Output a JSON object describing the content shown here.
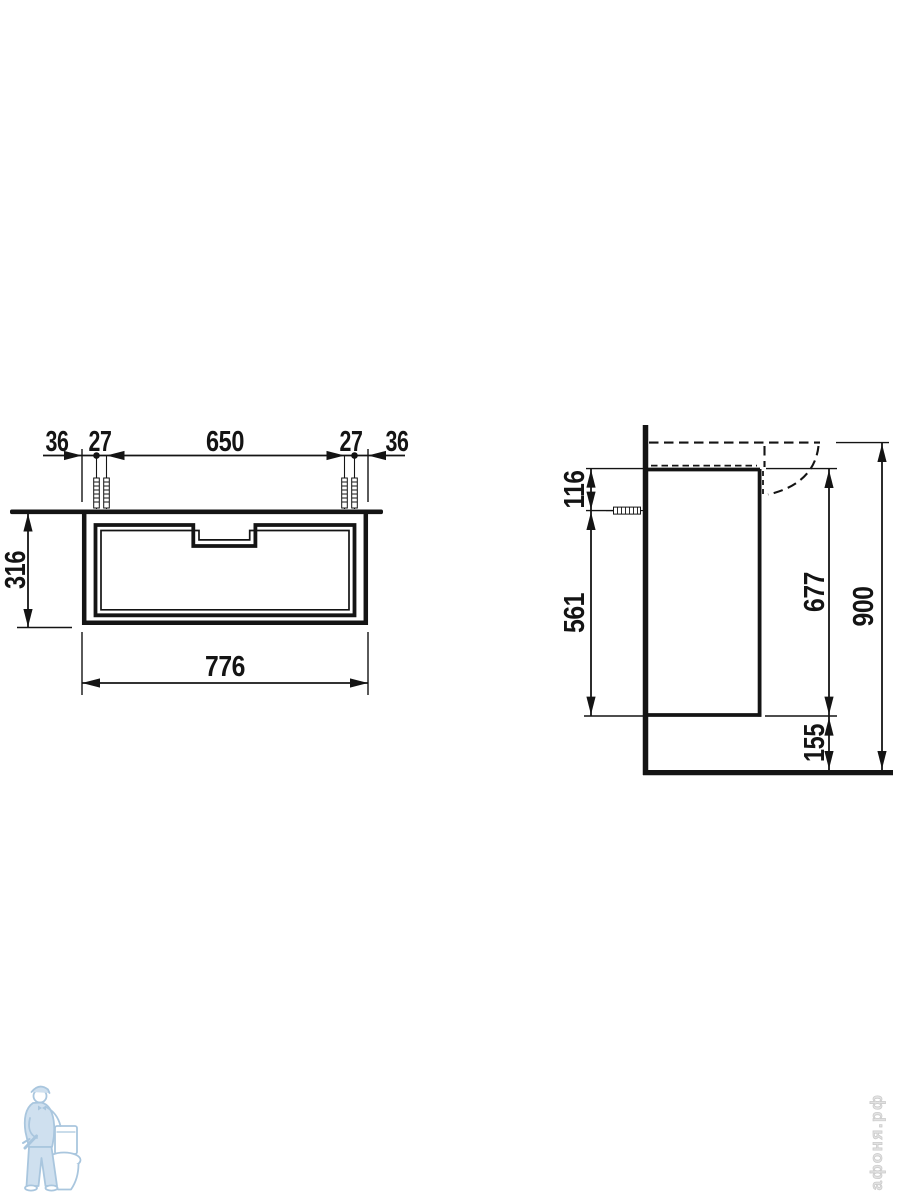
{
  "page": {
    "background": "#ffffff",
    "description": "Vanity unit installation technical drawing, front and side views"
  },
  "dims": {
    "front": {
      "gap_left": "36",
      "pitch_left": "27",
      "span_center": "650",
      "pitch_right": "27",
      "gap_right": "36",
      "height": "316",
      "width": "776"
    },
    "side": {
      "top_to_fixing": "116",
      "fixing_to_bottom": "561",
      "cabinet_height": "677",
      "floor_clearance": "155",
      "total_height": "900"
    }
  },
  "watermarks": {
    "site_text": "афоня.рф",
    "logo": "plumber-with-toilet"
  },
  "colors": {
    "line": "#141414",
    "watermark_blue": "#a9c6de",
    "watermark_blue_fill": "#cfe0ef",
    "watermark_gray": "#e2e2e2"
  }
}
